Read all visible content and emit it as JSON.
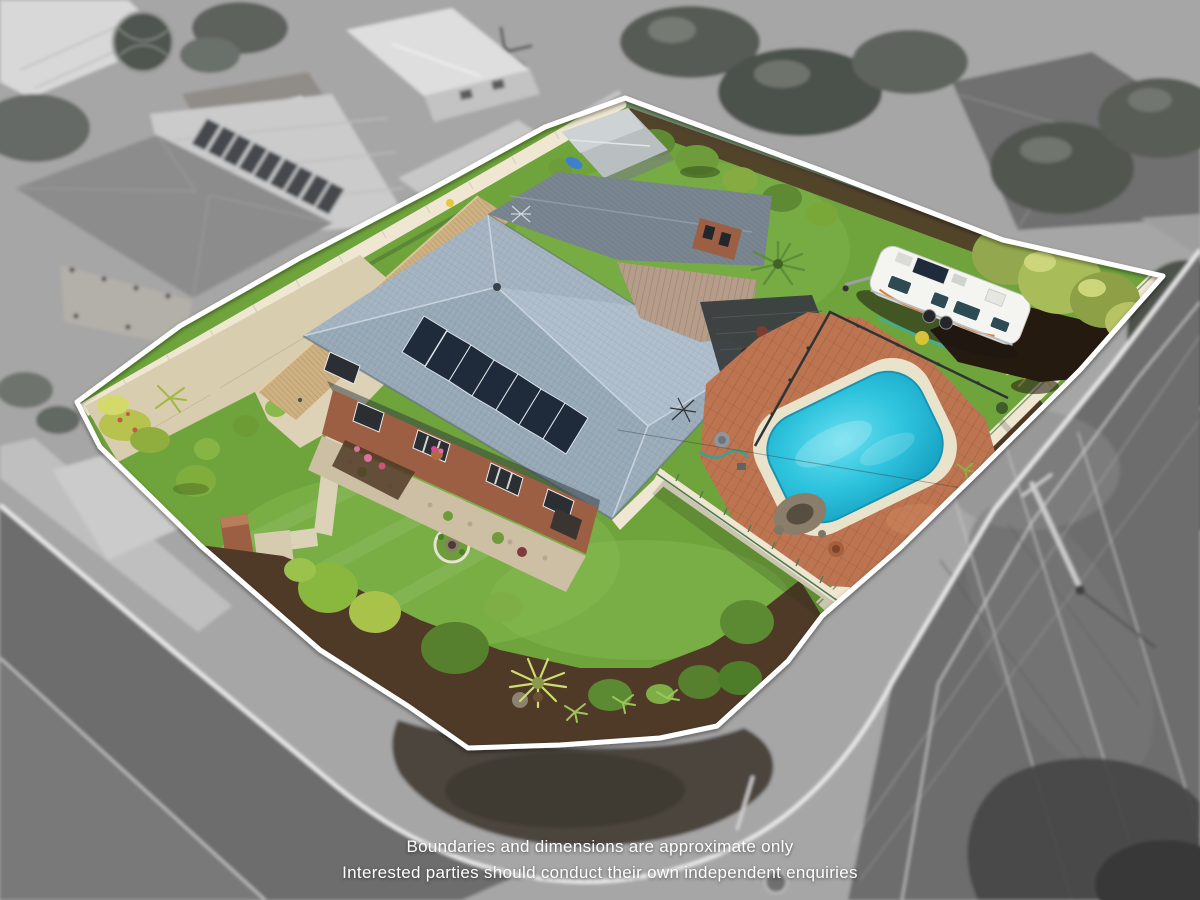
{
  "disclaimer": {
    "line1": "Boundaries and dimensions are approximate only",
    "line2": "Interested parties should conduct their own independent enquiries"
  },
  "colors": {
    "boundary_line": "#ffffff",
    "text_white": "#ffffff",
    "lawn_green": "#6fa33c",
    "lawn_light": "#8cbf57",
    "driveway_concrete": "#d9cdb0",
    "path_concrete": "#dbd2b8",
    "mulch_brown": "#4f3a27",
    "shrub_green": "#5c8a33",
    "shrub_yellow_green": "#a9c24a",
    "roof_tile": "#9aabb9",
    "roof_tile_light": "#aebdcb",
    "roof_metal": "#76828d",
    "solar_panel": "#1f2b3a",
    "deck_timber": "#cdb183",
    "pergola_shade": "#3a3e41",
    "patio_roof": "#b59d8a",
    "brick_wall": "#9c5f44",
    "pool_water": "#2ec3dd",
    "pool_coping": "#eae3cc",
    "pool_paving": "#bc7550",
    "fence_cream": "#efe7d2",
    "fence_green_rail": "#4e7a55",
    "fence_colorbond_green": "#74906b",
    "caravan_body": "#f4f4f1",
    "caravan_accent": "#e07a2e",
    "hedge_green": "#a9bc5a",
    "road_grey": "#6d6d6d",
    "verge_grey": "#a6a6a6",
    "foliage_grey": "#565b54",
    "concrete_grey": "#c9c9c9"
  }
}
